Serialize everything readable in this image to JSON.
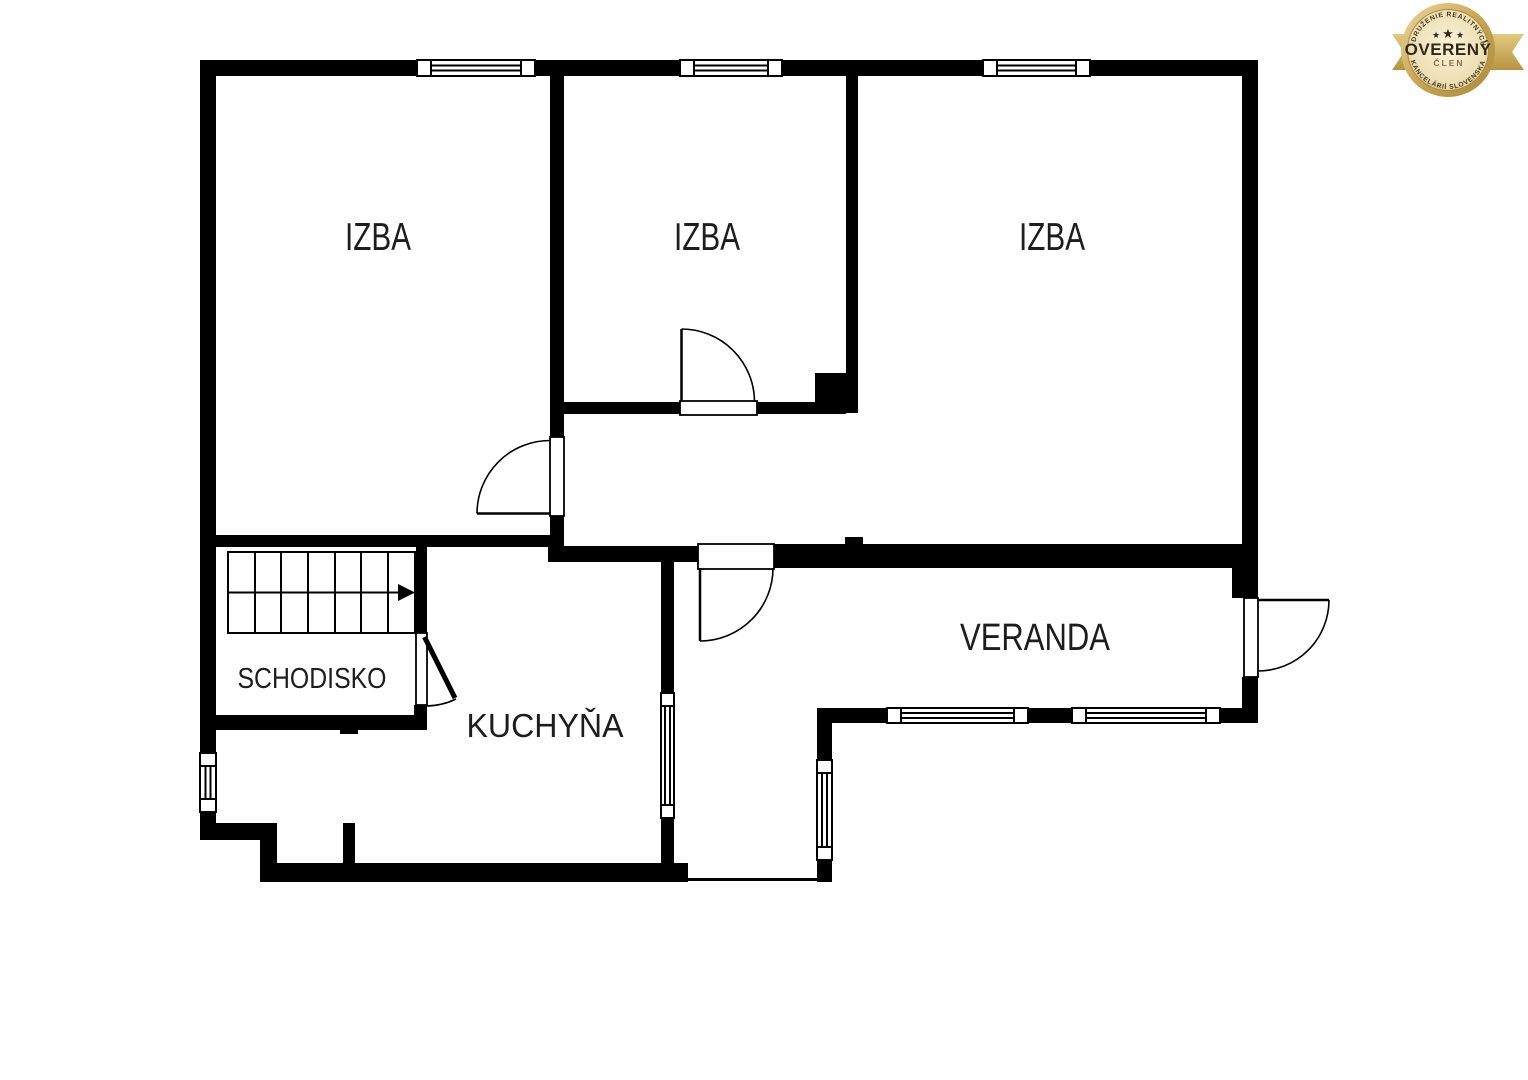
{
  "floor_plan": {
    "background": "#ffffff",
    "wall_color": "#000000",
    "line_color": "#000000",
    "label_color": "#1d1d1d",
    "rooms": {
      "izba_left": {
        "label": "IZBA"
      },
      "izba_middle": {
        "label": "IZBA"
      },
      "izba_right": {
        "label": "IZBA"
      },
      "veranda": {
        "label": "VERANDA"
      },
      "schodisko": {
        "label": "SCHODISKO"
      },
      "kuchyna": {
        "label": "KUCHYŇA"
      }
    }
  },
  "badge": {
    "arc_text_top": "ZDRUŽENIE REALITNÝCH",
    "title": "OVERENÝ",
    "subtitle": "ČLEN",
    "arc_text_bottom": "KANCELÁRIÍ SLOVENSKA",
    "star": "★",
    "colors": {
      "ribbon": "#cfa952",
      "ring_light": "#ecd9a0",
      "ring_dark": "#b6933f",
      "face_light": "#faf3d9",
      "face_dark": "#dcc488",
      "text_dark": "#33291a",
      "text_gold": "#8a6f3e"
    }
  }
}
